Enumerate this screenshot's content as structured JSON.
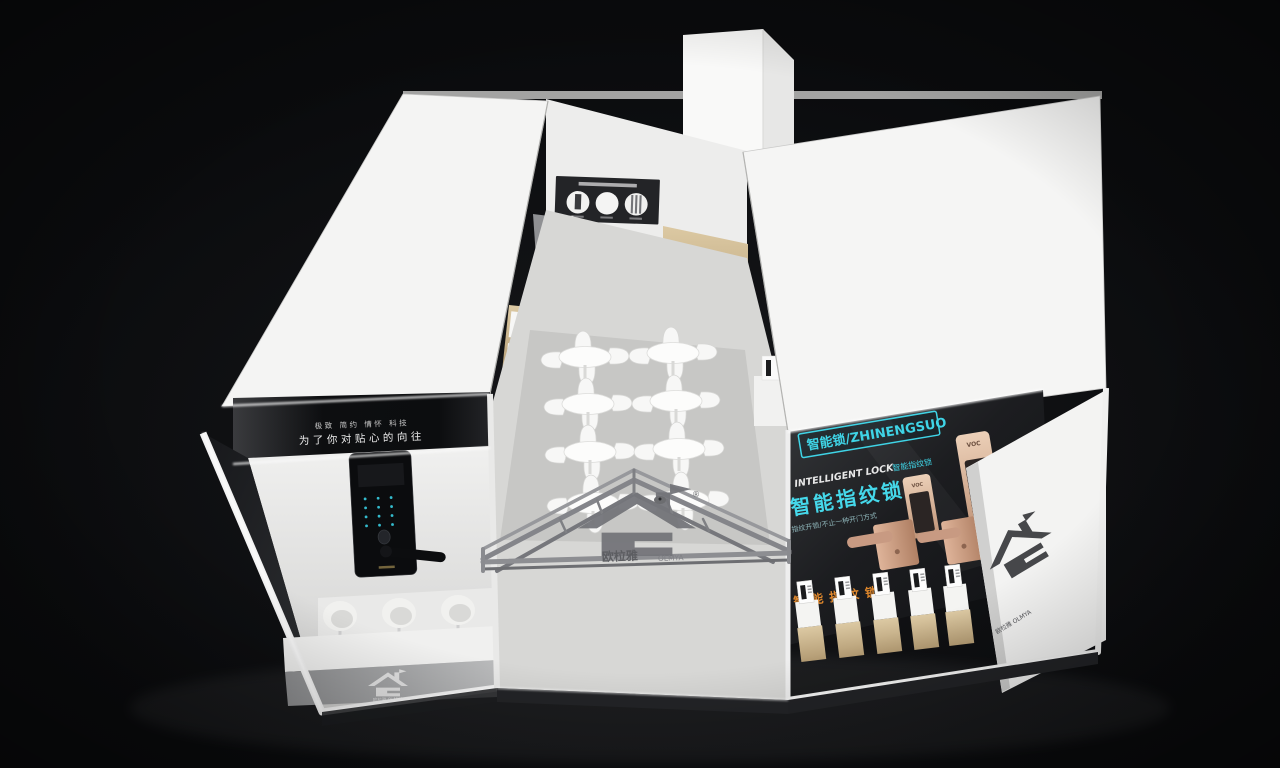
{
  "scene": {
    "description": "3D render of a smart-lock brand exhibition booth seen from an elevated front view on a black background",
    "background": "#0a0b0d"
  },
  "palette": {
    "booth_white": "#f4f4f3",
    "banner_black": "#101214",
    "accent_cyan": "#3fd4e6",
    "accent_orange": "#e0882c",
    "wood": "#cdb794",
    "rose_gold": "#d8ab93",
    "floor_gray": "#d7d7d5",
    "truss_gray": "#88898c"
  },
  "left_wall": {
    "slogan_small": "极致 简约 情怀 科技",
    "slogan_main": "为了你对贴心的向往"
  },
  "right_wall": {
    "badge": "智能锁/ZHINENGSUO",
    "heading_en": "INTELLIGENT LOCK",
    "heading_cn": "智能指纹锁",
    "headline": "智能指纹锁",
    "subline": "指纹开锁/不止一种开门方式",
    "accent_text": "智能指纹锁",
    "lock_brand": "VOC"
  },
  "brand": {
    "name_cn": "欧柆雅",
    "name_en": "OLMYA",
    "registered": "®",
    "caption": "欧柆雅 OLMYA"
  }
}
